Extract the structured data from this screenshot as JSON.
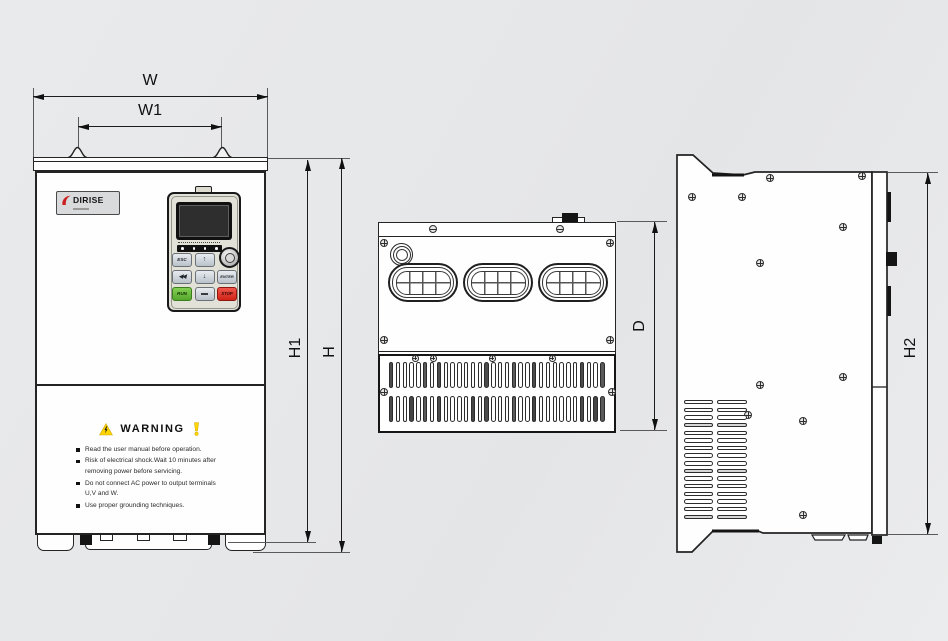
{
  "drawing": {
    "kind": "inverter dimension drawing",
    "views": [
      "front",
      "top",
      "side"
    ]
  },
  "dimensions": {
    "W": "W",
    "W1": "W1",
    "H1": "H1",
    "H": "H",
    "D": "D",
    "H2": "H2"
  },
  "front_view": {
    "brand": {
      "name": "DIRISE"
    },
    "keypad": {
      "led_count": 4,
      "buttons": {
        "esc": "ESC",
        "up": "↑",
        "shift": "◀◀",
        "down": "↓",
        "enter": "ENTER",
        "run": "RUN",
        "stop": "STOP"
      }
    },
    "warning": {
      "title": "WARNING",
      "items": [
        "Read the user manual before operation.",
        "Risk of electrical shock.Wait 10 minutes after removing power before servicing.",
        "Do not connect AC power to output terminals U,V and W.",
        "Use proper grounding techniques."
      ]
    }
  },
  "colors": {
    "run_green": "#67bd3a",
    "stop_red": "#d8291d",
    "warning_yellow": "#ffd400",
    "logo_red": "#cc1f1f",
    "outline": "#242424",
    "background": "#e7e8e9"
  }
}
